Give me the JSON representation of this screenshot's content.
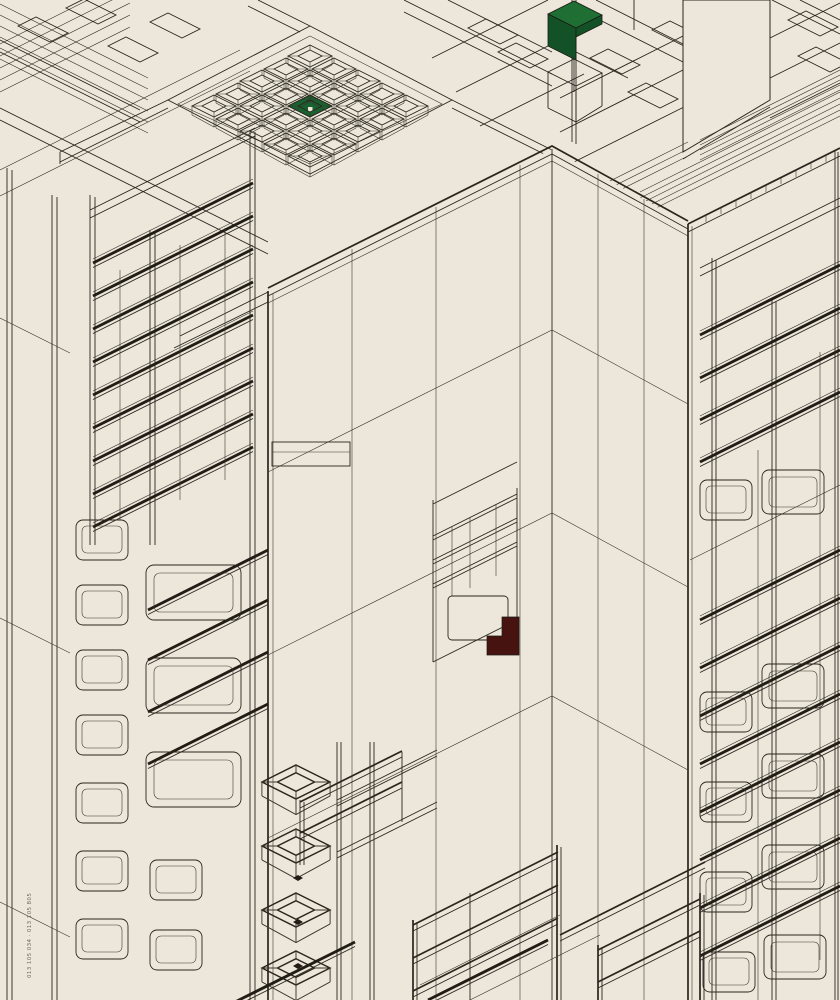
{
  "artwork": {
    "caption": "013 105 034 · 013 105 805",
    "palette": {
      "paper": "#ece7da",
      "ink": "#2a261e",
      "green_top": "#1f6f35",
      "green_side": "#135226",
      "green_tile": "#1a6130",
      "maroon": "#471310",
      "caption_color": "#6b665c"
    },
    "inventory": {
      "central_tower": "tall slab tower, two axonometric faces with panel grid",
      "plaza_grid": "5x5 field of open concrete-block cubes, centre cube roof green",
      "green_fold": "green folded roof element on open cube frame, top centre",
      "maroon_block": "dark maroon notched block inside mid-tower niche",
      "left_rack": "scaffold rack with dark shelf bands and stacked trays",
      "right_rack": "scaffold rack with shelf bands and open boxes",
      "railings": "open railing frames at the tower base",
      "credit_line": "tiny vertical credit text on left margin"
    }
  }
}
